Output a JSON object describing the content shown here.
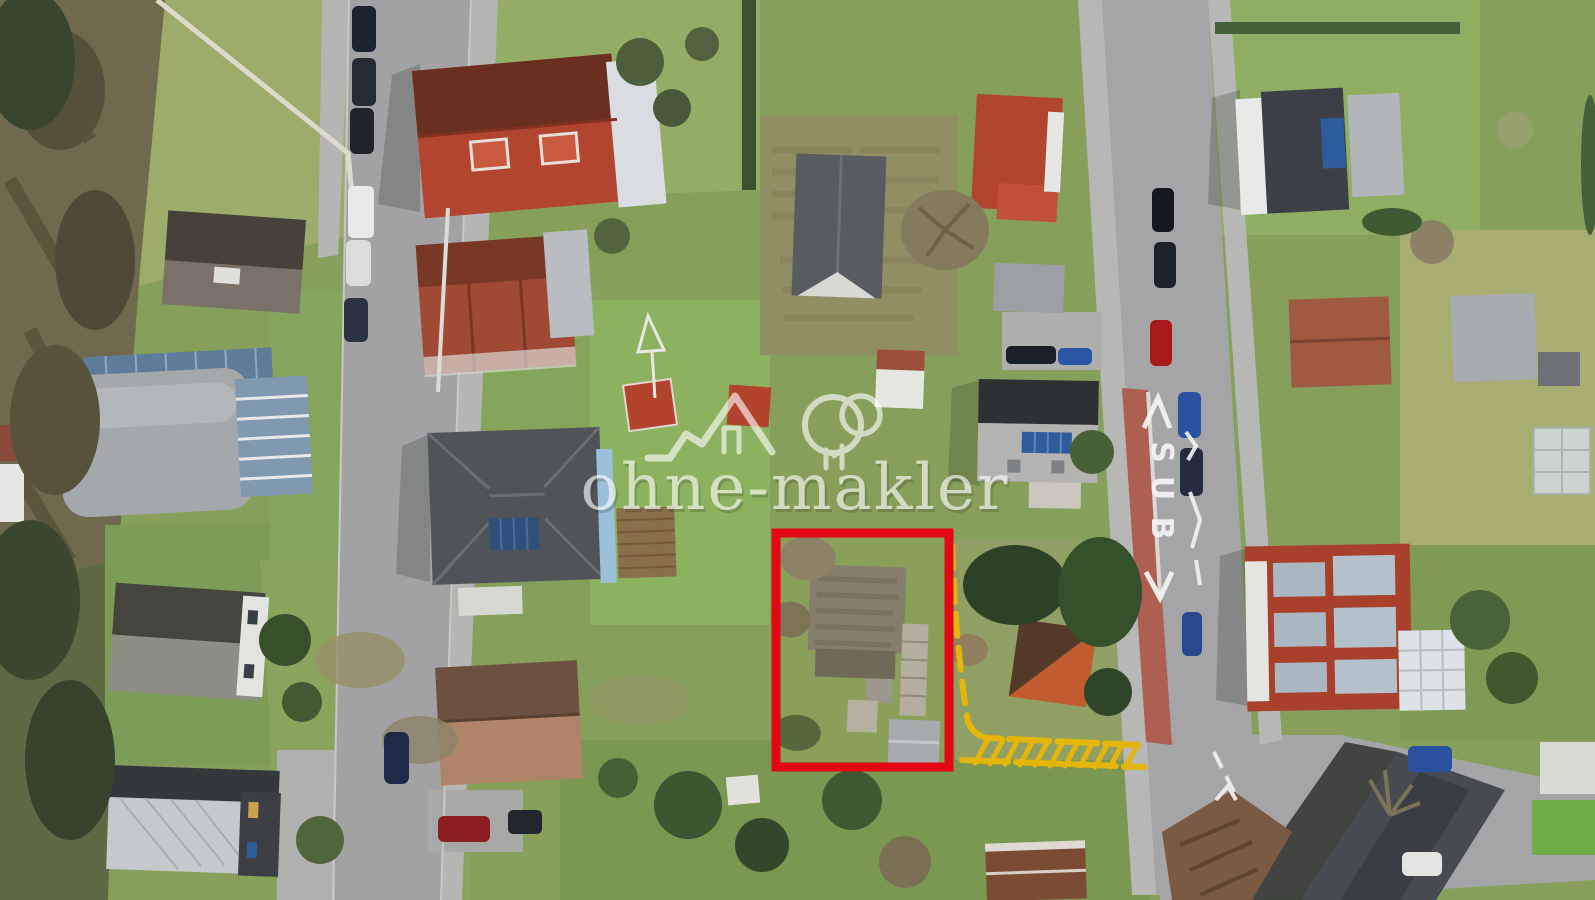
{
  "scene": {
    "type": "aerial-drone-photograph",
    "subject": "residential neighborhood, top-down view, with one plot outlined"
  },
  "watermark": {
    "brand": "ohne-makler",
    "logo": "house-and-two-trees-outline",
    "color": "#ffffff"
  },
  "annotations": {
    "plot_outline": {
      "shape": "rectangle",
      "color": "#e30613"
    },
    "access_path": {
      "style": "dashed-hatched-line",
      "color": "#e6b50a"
    }
  },
  "road_marking": {
    "text": "BUS",
    "letters": [
      "S",
      "U",
      "B"
    ],
    "color": "#f5f5f5",
    "type": "bus-stop-zigzag"
  }
}
